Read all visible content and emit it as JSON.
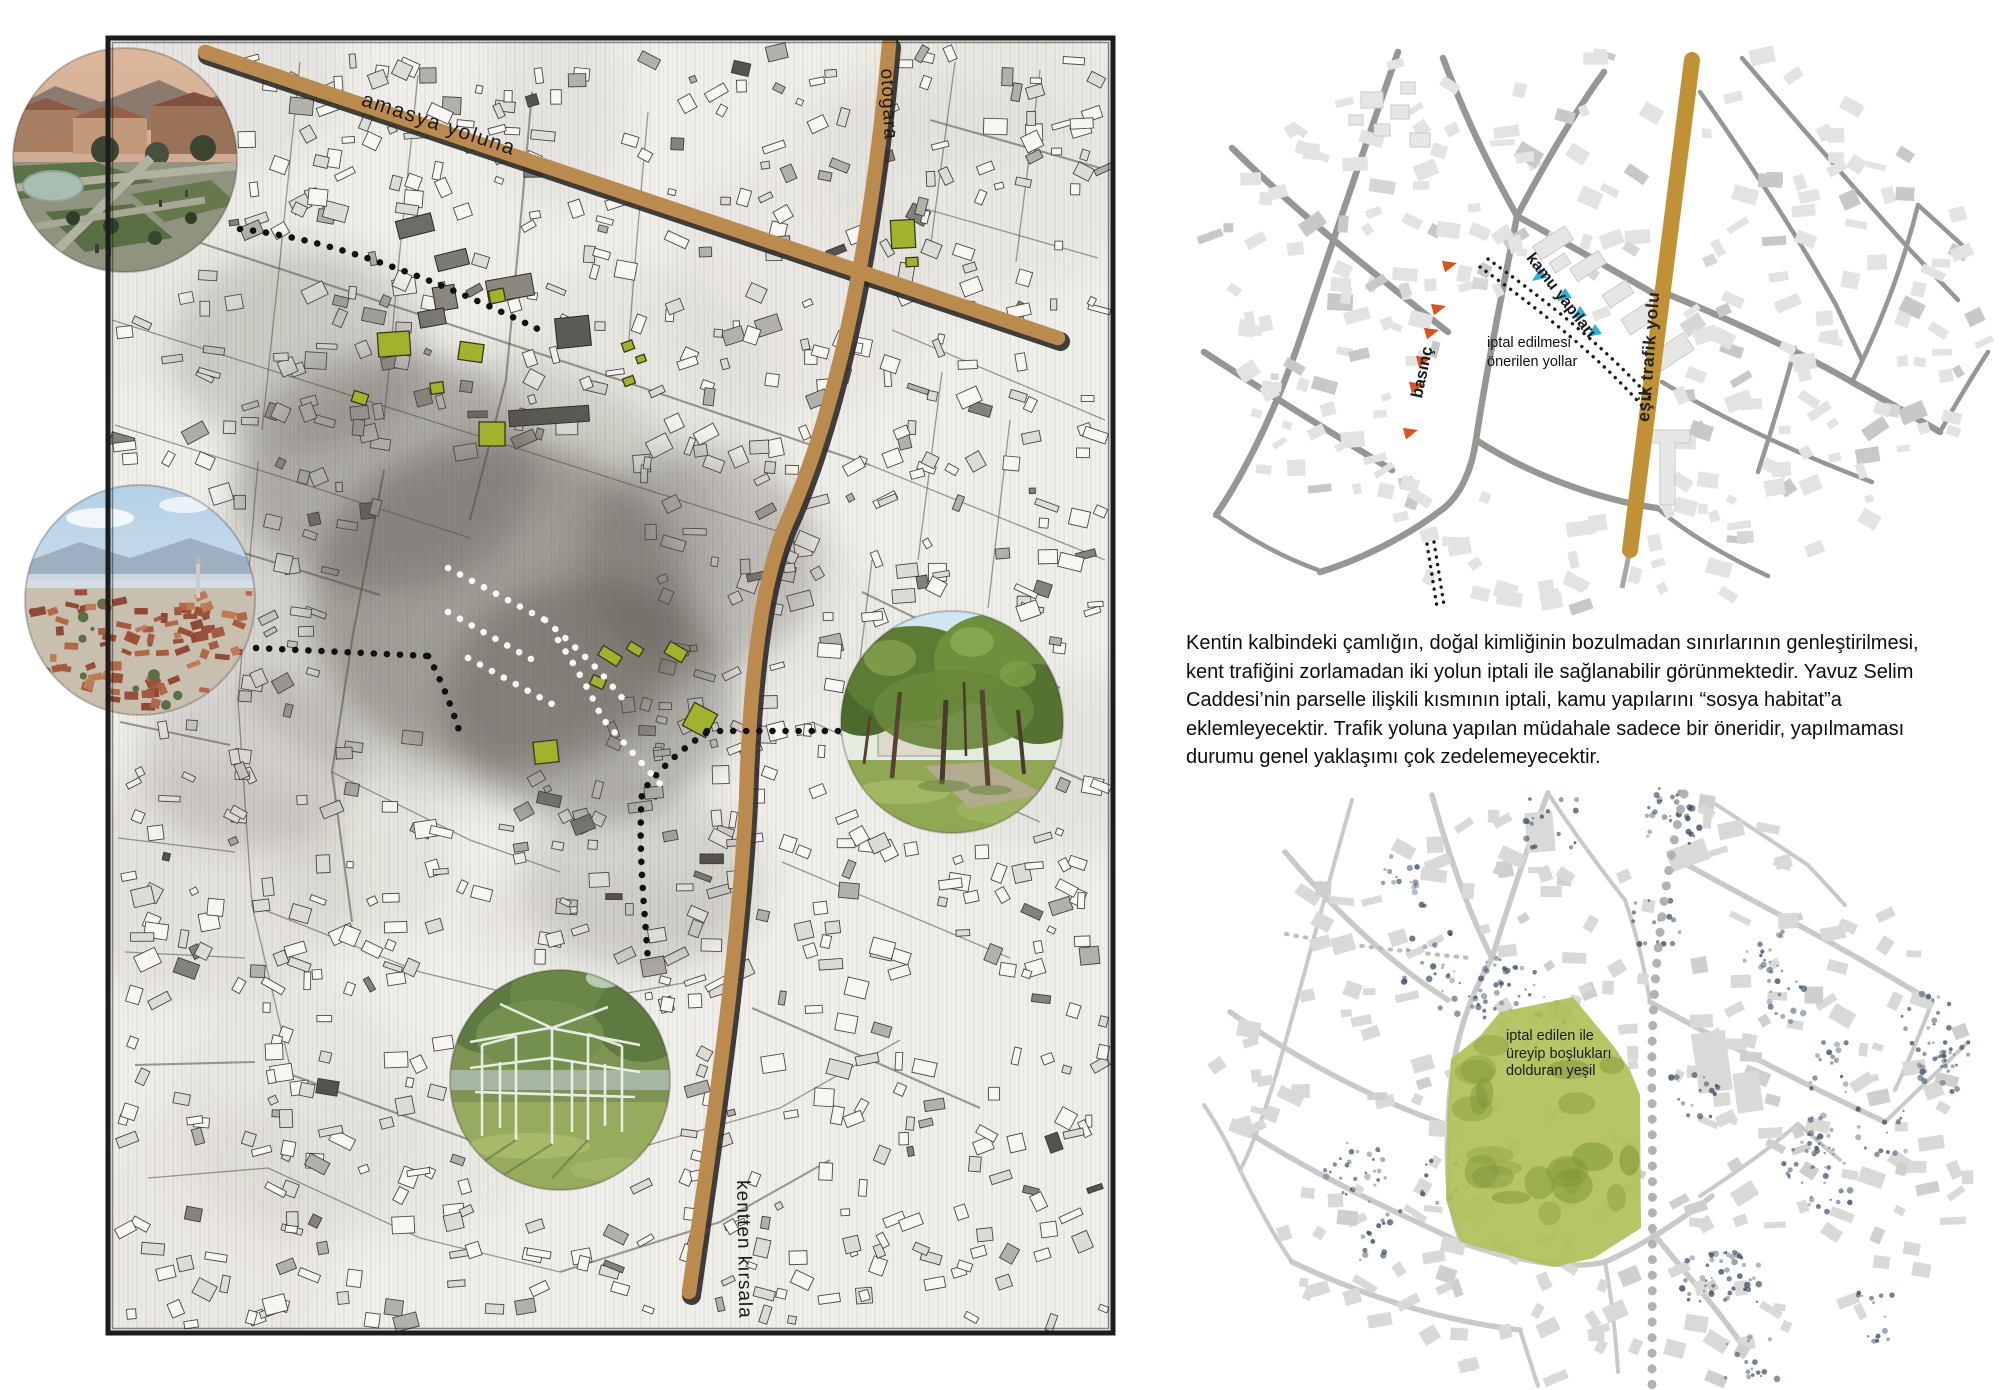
{
  "board": {
    "map": {
      "label_amasya": "amasya yoluna",
      "label_otogar": "otogara",
      "label_rural": "kentten kırsala",
      "road_color": "#bb8a4e",
      "green_building_color": "#a3b22c"
    },
    "diagram_top": {
      "label_main_road": "eşik trafik yolu",
      "label_public": "kamu yapıları",
      "label_pressure": "basınç",
      "label_cancel": "iptal edilmesi\nönerilen yollar",
      "colors": {
        "road": "#c19136",
        "public": "#29b3d6",
        "pressure": "#d9531e",
        "street": "#969692"
      }
    },
    "paragraph": "Kentin kalbindeki çamlığın, doğal kimliğinin bozulmadan sınırlarının genleştirilmesi,\nkent trafiğini zorlamadan iki yolun iptali ile sağlanabilir görünmektedir. Yavuz Selim\nCaddesi’nin parselle ilişkili kısmının iptali, kamu yapılarını “sosya habitat”a\neklemleyecektir. Trafik yoluna yapılan müdahale sadece bir öneridir, yapılmaması\ndurumu genel yaklaşımı çok zedelemeyecektir.",
    "diagram_bottom": {
      "label_green": "iptal edilen ile\nüreyip boşlukları\ndolduran yeşil",
      "colors": {
        "green": "#b2c05a",
        "street": "#c9c9c7",
        "trees": "#3e5068"
      }
    }
  }
}
